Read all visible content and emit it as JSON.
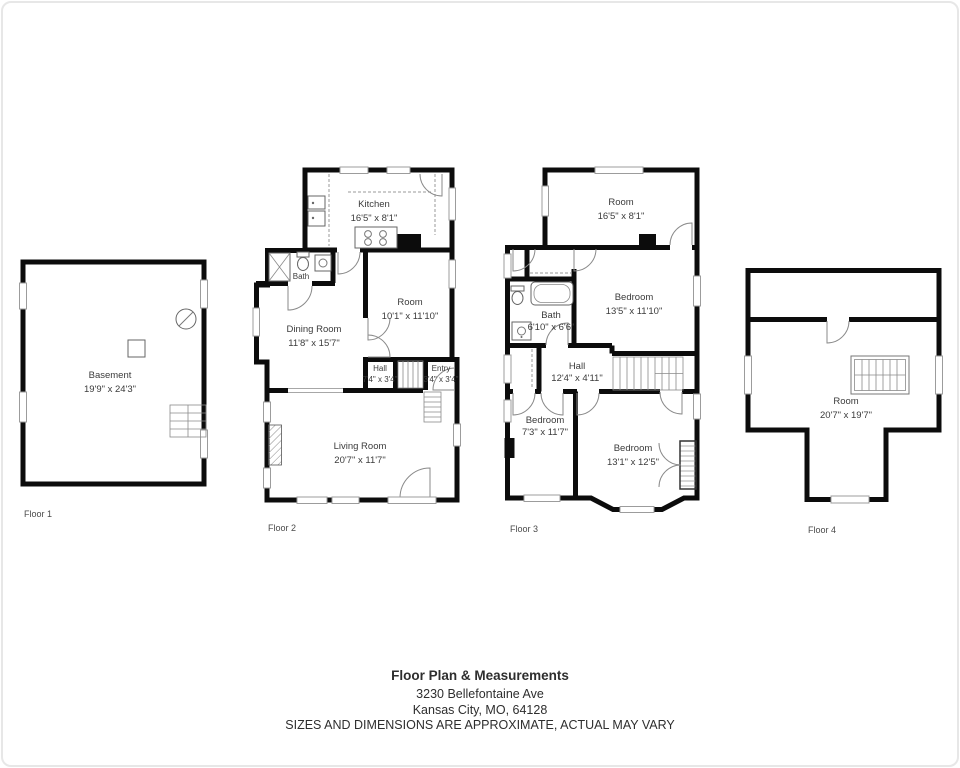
{
  "footer": {
    "title": "Floor Plan & Measurements",
    "address_line1": "3230 Bellefontaine Ave",
    "address_line2": "Kansas City, MO, 64128",
    "disclaimer": "SIZES AND DIMENSIONS ARE APPROXIMATE, ACTUAL MAY VARY"
  },
  "colors": {
    "wall": "#0c0c0c",
    "label_text": "#3b3b3b"
  },
  "floors": {
    "floor1": {
      "label": "Floor 1",
      "basement": {
        "name": "Basement",
        "dims": "19'9\" x 24'3\""
      }
    },
    "floor2": {
      "label": "Floor 2",
      "kitchen": {
        "name": "Kitchen",
        "dims": "16'5\" x 8'1\""
      },
      "bath": {
        "name": "Bath",
        "dims": "6'0\" x 3'0\""
      },
      "dining": {
        "name": "Dining Room",
        "dims": "11'8\" x 15'7\""
      },
      "room": {
        "name": "Room",
        "dims": "10'1\" x 11'10\""
      },
      "hall": {
        "name": "Hall",
        "dims": "7'4\" x 3'4\""
      },
      "entry": {
        "name": "Entry",
        "dims": "3'4\" x 3'4\""
      },
      "living": {
        "name": "Living Room",
        "dims": "20'7\" x 11'7\""
      }
    },
    "floor3": {
      "label": "Floor 3",
      "room": {
        "name": "Room",
        "dims": "16'5\" x 8'1\""
      },
      "bedroom1": {
        "name": "Bedroom",
        "dims": "13'5\" x 11'10\""
      },
      "bath": {
        "name": "Bath",
        "dims": "6'10\" x 6'6\""
      },
      "hall": {
        "name": "Hall",
        "dims": "12'4\" x 4'11\""
      },
      "bedroom2": {
        "name": "Bedroom",
        "dims": "7'3\" x 11'7\""
      },
      "bedroom3": {
        "name": "Bedroom",
        "dims": "13'1\" x 12'5\""
      }
    },
    "floor4": {
      "label": "Floor 4",
      "room": {
        "name": "Room",
        "dims": "20'7\" x 19'7\""
      }
    }
  }
}
